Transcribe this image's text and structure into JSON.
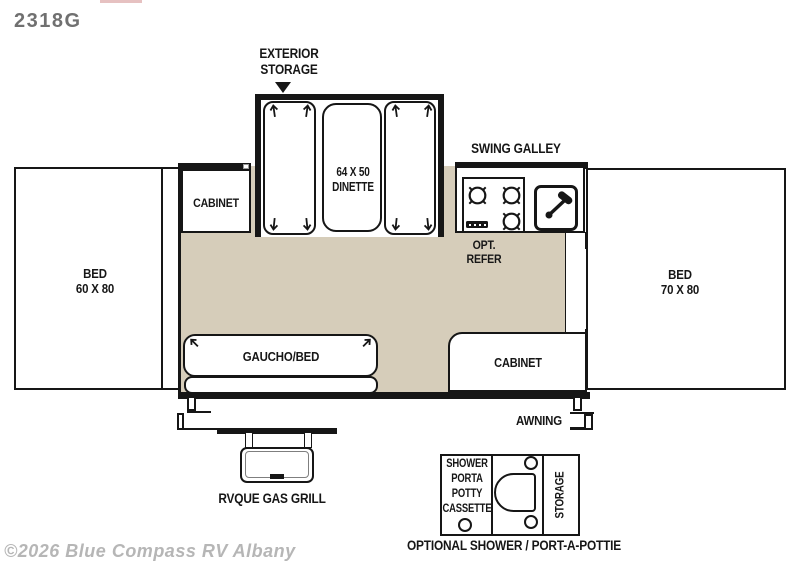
{
  "model": "2318G",
  "watermark": "©2026 Blue Compass RV Albany",
  "colors": {
    "floor": "#d6cdba",
    "line": "#161616",
    "title": "#707070",
    "watermark_gray": "#b6b6b6",
    "top_accent": "#e0b1b1"
  },
  "labels": {
    "exterior_storage": [
      "EXTERIOR",
      "STORAGE"
    ],
    "swing_galley": "SWING GALLEY",
    "dinette": [
      "64 X 50",
      "DINETTE"
    ],
    "opt_refer": [
      "OPT.",
      "REFER"
    ],
    "cabinet_top": "CABINET",
    "cabinet_bottom": "CABINET",
    "bed_left": [
      "BED",
      "60 X 80"
    ],
    "bed_right": [
      "BED",
      "70 X 80"
    ],
    "gaucho": "GAUCHO/BED",
    "awning": "AWNING",
    "grill": "RVQUE GAS GRILL",
    "potty": [
      "SHOWER",
      "PORTA",
      "POTTY",
      "CASSETTE"
    ],
    "storage_vertical": "STORAGE",
    "optional_caption": "OPTIONAL SHOWER / PORT-A-POTTIE"
  },
  "icons": {
    "burner_count": 3,
    "slide_arrows": "direction arrows on dinette benches and gaucho"
  }
}
